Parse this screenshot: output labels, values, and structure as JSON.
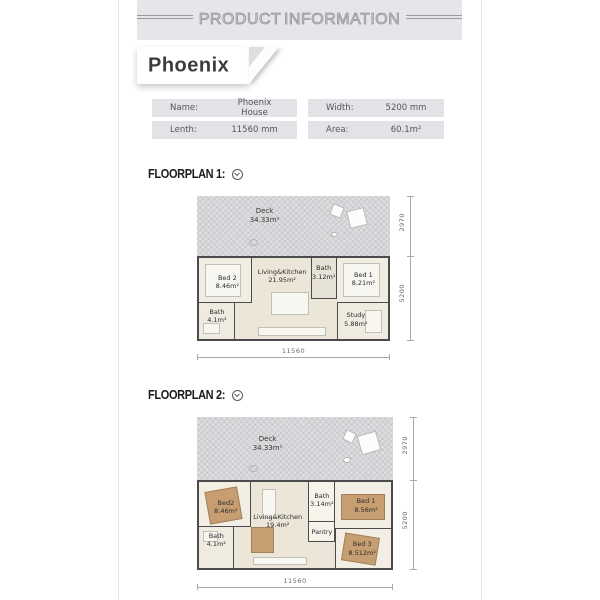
{
  "header": {
    "title": "PRODUCT INFORMATION"
  },
  "ribbon": {
    "title": "Phoenix"
  },
  "specs": {
    "name_label": "Name:",
    "name_value": "Phoenix House",
    "width_label": "Width:",
    "width_value": "5200 mm",
    "length_label": "Lenth:",
    "length_value": "11560 mm",
    "area_label": "Area:",
    "area_value": "60.1m²"
  },
  "floorplan1": {
    "heading": "FLOORPLAN 1:",
    "deck": {
      "name": "Deck",
      "area": "34.33m²"
    },
    "rooms": {
      "bed2": {
        "name": "Bed 2",
        "area": "8.46m²"
      },
      "living": {
        "name": "Living&Kitchen",
        "area": "21.95m²"
      },
      "bath_small": {
        "name": "Bath",
        "area": "3.12m²"
      },
      "bed1": {
        "name": "Bed 1",
        "area": "8.21m²"
      },
      "bath": {
        "name": "Bath",
        "area": "4.1m²"
      },
      "study": {
        "name": "Study",
        "area": "5.88m²"
      }
    },
    "dims": {
      "deck_depth": "2970",
      "house_depth": "5200",
      "width": "11560"
    }
  },
  "floorplan2": {
    "heading": "FLOORPLAN 2:",
    "deck": {
      "name": "Deck",
      "area": "34.33m²"
    },
    "rooms": {
      "bed2": {
        "name": "Bed2",
        "area": "8.46m²"
      },
      "living": {
        "name": "Living&Kitchen",
        "area": "19.4m²"
      },
      "bath_small": {
        "name": "Bath",
        "area": "3.14m²"
      },
      "pantry": {
        "name": "Pantry"
      },
      "bed1": {
        "name": "Bed 1",
        "area": "8.56m²"
      },
      "bath": {
        "name": "Bath",
        "area": "4.1m²"
      },
      "bed3": {
        "name": "Bed 3",
        "area": "8.512m²"
      }
    },
    "dims": {
      "deck_depth": "2970",
      "house_depth": "5200",
      "width": "11560"
    }
  },
  "colors": {
    "wall": "#4b4b4d",
    "deck_bg": "#dddde0",
    "floor_bg": "#ece6d8",
    "tan_furniture": "#c79e72",
    "band_bg": "#e6e6ea",
    "cell_bg": "#e3e3e7"
  }
}
